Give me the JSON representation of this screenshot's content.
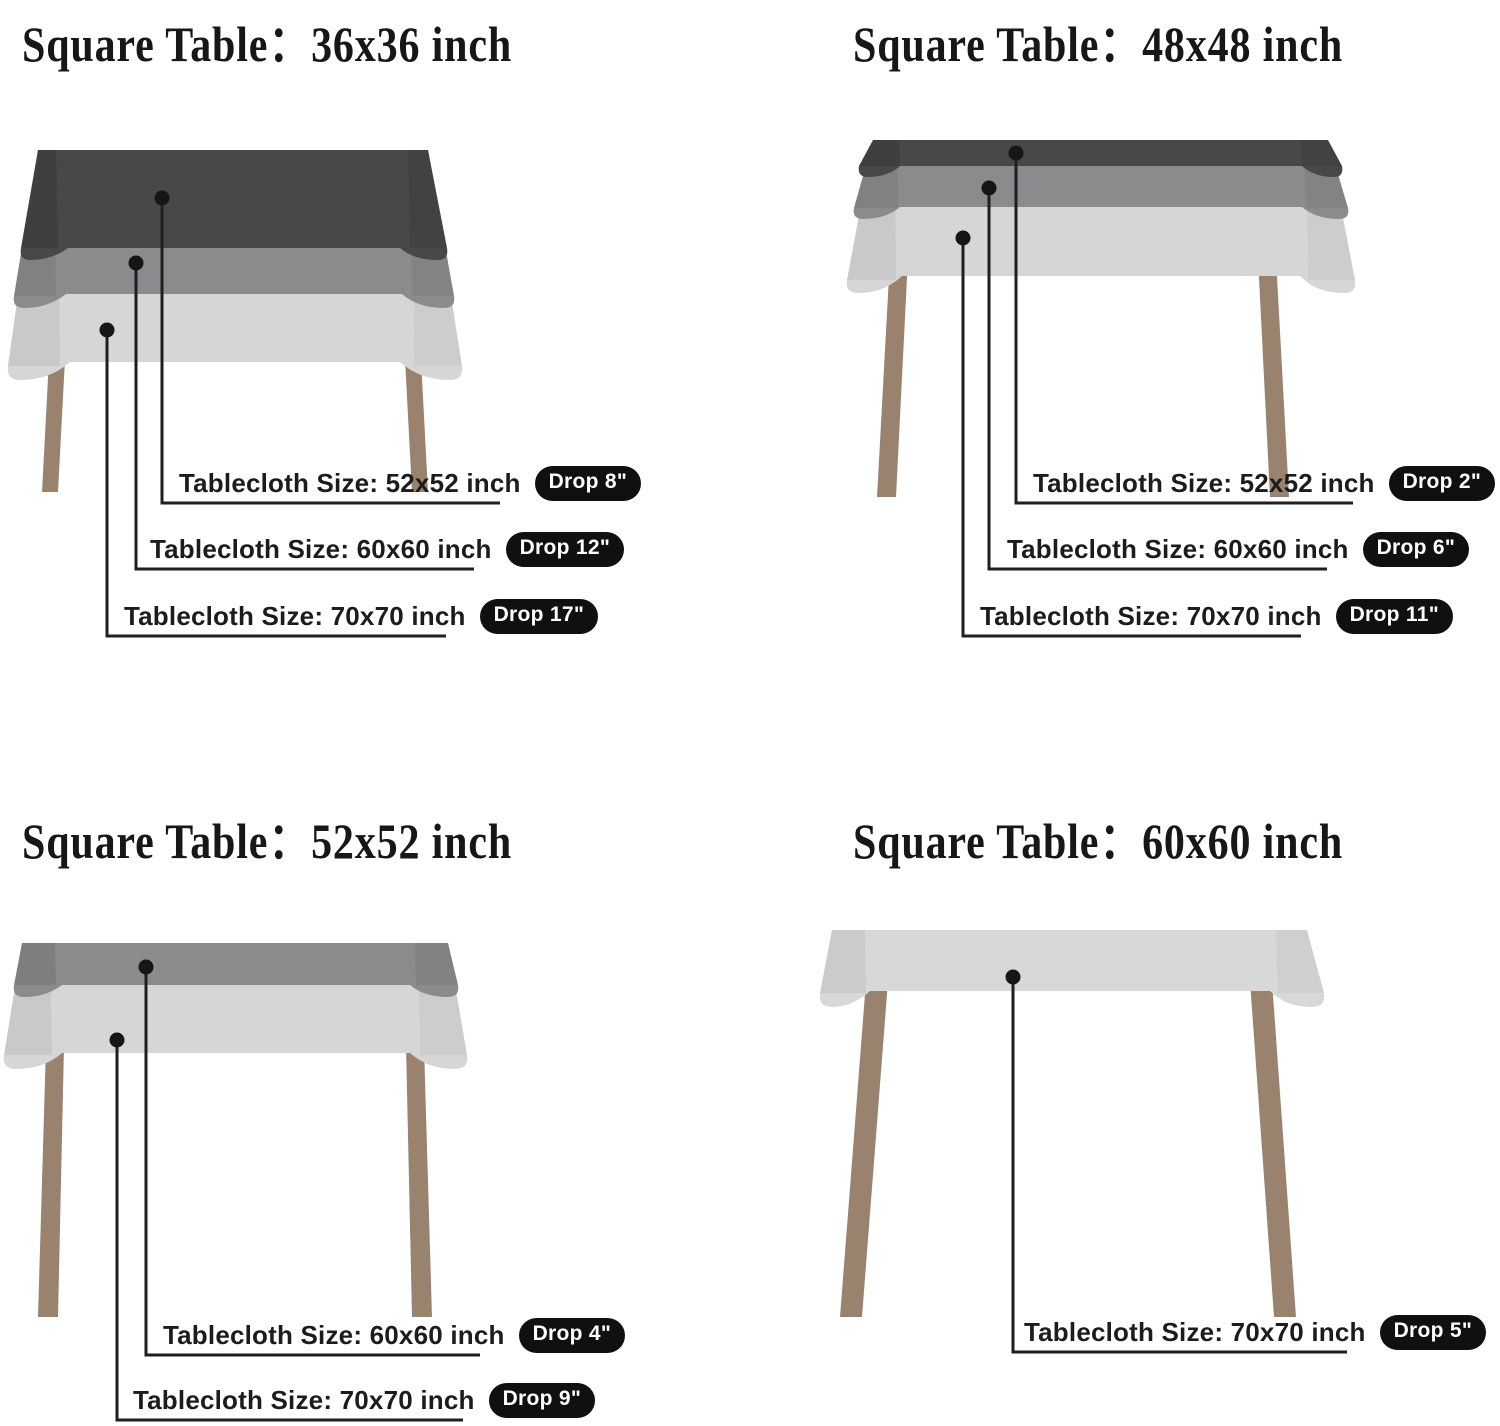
{
  "colors": {
    "cloth_dark": "#48484a",
    "cloth_medium": "#8b8b8d",
    "cloth_light": "#d6d6d7",
    "table_leg": "#9a836e",
    "callout_line": "#1f1f1f",
    "badge_bg": "#101010",
    "badge_text": "#ffffff"
  },
  "sections": [
    {
      "title": "Square Table：36x36 inch",
      "labels": [
        {
          "text": "Tablecloth Size: 52x52 inch",
          "badge": "Drop 8\""
        },
        {
          "text": "Tablecloth Size: 60x60 inch",
          "badge": "Drop 12\""
        },
        {
          "text": "Tablecloth Size: 70x70 inch",
          "badge": "Drop 17\""
        }
      ]
    },
    {
      "title": "Square Table：48x48 inch",
      "labels": [
        {
          "text": "Tablecloth Size: 52x52 inch",
          "badge": "Drop 2\""
        },
        {
          "text": "Tablecloth Size: 60x60 inch",
          "badge": "Drop 6\""
        },
        {
          "text": "Tablecloth Size: 70x70 inch",
          "badge": "Drop 11\""
        }
      ]
    },
    {
      "title": "Square Table：52x52 inch",
      "labels": [
        {
          "text": "Tablecloth Size: 60x60 inch",
          "badge": "Drop 4\""
        },
        {
          "text": "Tablecloth Size: 70x70 inch",
          "badge": "Drop 9\""
        }
      ]
    },
    {
      "title": "Square Table：60x60 inch",
      "labels": [
        {
          "text": "Tablecloth Size: 70x70 inch",
          "badge": "Drop 5\""
        }
      ]
    }
  ]
}
